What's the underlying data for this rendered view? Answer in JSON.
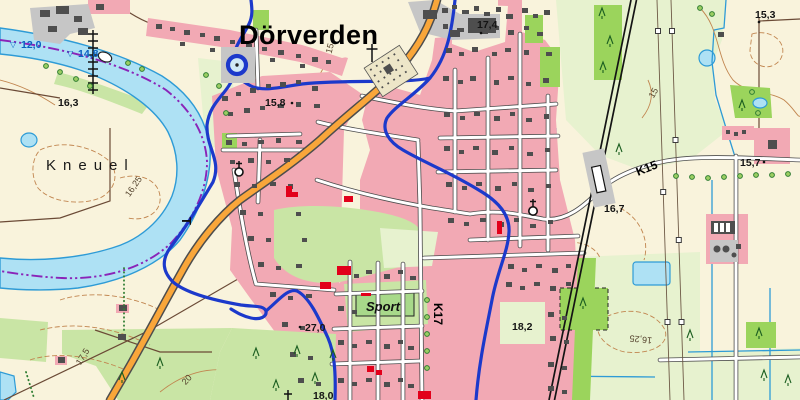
{
  "title": "Dörverden",
  "area_label": "Kneuel",
  "sport_label": "Sport",
  "roads": {
    "k15": "K15",
    "k17": "K17"
  },
  "gauges": [
    {
      "icon": "▽",
      "value": "12,0"
    },
    {
      "icon": "▽",
      "value": "14,8"
    }
  ],
  "heights": {
    "h163": "16,3",
    "h158": "15,8",
    "h174": "17,4",
    "h153": "15,3",
    "h157": "15,7",
    "h167": "16,7",
    "h182": "18,2",
    "h270": "27,0",
    "h180": "18,0"
  },
  "contours": {
    "c15a": "15",
    "c15b": "15",
    "c1625a": "16,25",
    "c1625b": "16,25",
    "c175": "17,5",
    "c20": "20"
  },
  "ferry_marker": "T",
  "palette": {
    "cream": "#F9F3DC",
    "palegreen": "#E7F2CF",
    "midgreen": "#C9E5A5",
    "brightgreen": "#9BD45C",
    "sportgreen": "#A8D98A",
    "pink": "#F2A9B4",
    "gray": "#C6C6C6",
    "bld": "#4E4E4E",
    "red": "#E2001A",
    "orange": "#F9A63A",
    "casing": "#4d4d4d",
    "waterfill": "#AEE1F4",
    "waterline": "#2E9BD6",
    "blueb": "#1C39CB",
    "purpleb": "#8A24B8",
    "rail": "#141414",
    "contour": "#C1854F",
    "trackbrown": "#6b4a36",
    "labelblue": "#0A62C2",
    "labelblack": "#141414"
  }
}
